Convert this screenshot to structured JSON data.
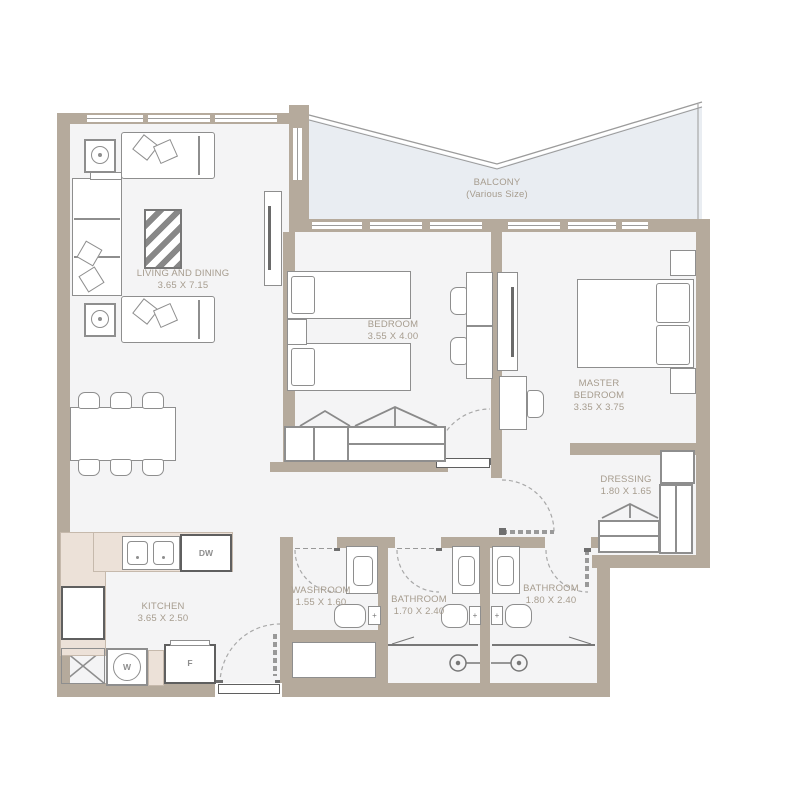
{
  "plan": {
    "rooms": [
      {
        "name": "LIVING AND DINING",
        "dims": "3.65 X 7.15"
      },
      {
        "name": "BALCONY",
        "dims": "(Various Size)"
      },
      {
        "name": "BEDROOM",
        "dims": "3.55 X 4.00"
      },
      {
        "name": "MASTER BEDROOM",
        "dims": "3.35 X 3.75"
      },
      {
        "name": "DRESSING",
        "dims": "1.80 X 1.65"
      },
      {
        "name": "WASHROOM",
        "dims": "1.55 X 1.60"
      },
      {
        "name": "BATHROOM",
        "dims": "1.70 X 2.40"
      },
      {
        "name": "BATHROOM",
        "dims": "1.80 X 2.40"
      },
      {
        "name": "KITCHEN",
        "dims": "3.65 X 2.50"
      }
    ],
    "appliances": {
      "dishwasher": "DW",
      "washer": "W",
      "fridge": "F"
    },
    "colors": {
      "wall": "#b5aa9c",
      "floor": "#f4f4f5",
      "balcony_floor": "#e9edf2",
      "counter": "#ece1d8",
      "label_text": "#a69c8e",
      "line": "#8e8e8e"
    }
  }
}
